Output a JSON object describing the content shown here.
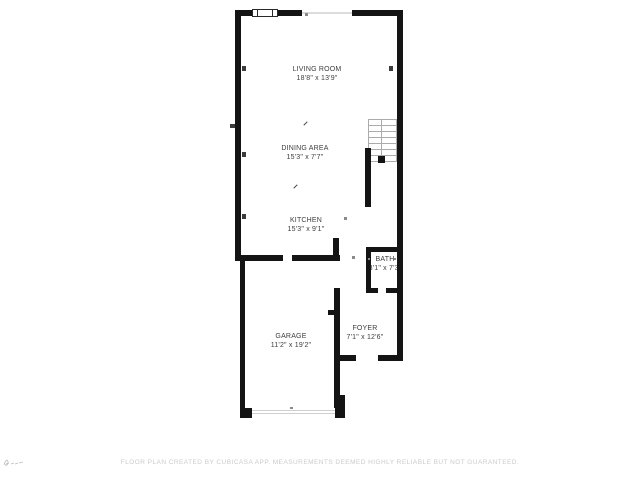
{
  "floorplan": {
    "rooms": [
      {
        "name": "LIVING ROOM",
        "dims": "18'8\" x 13'9\""
      },
      {
        "name": "DINING AREA",
        "dims": "15'3\" x 7'7\""
      },
      {
        "name": "KITCHEN",
        "dims": "15'3\" x 9'1\""
      },
      {
        "name": "BATH",
        "dims": "3'1\" x 7'3\""
      },
      {
        "name": "FOYER",
        "dims": "7'1\" x 12'6\""
      },
      {
        "name": "GARAGE",
        "dims": "11'2\" x 19'2\""
      }
    ],
    "disclaimer": "FLOOR PLAN CREATED BY CUBICASA APP. MEASUREMENTS DEEMED HIGHLY RELIABLE BUT NOT GUARANTEED.",
    "colors": {
      "wall": "#141414",
      "label": "#3d3d3d",
      "stair_line": "#ababab",
      "disclaimer": "#cbcbcb"
    }
  }
}
